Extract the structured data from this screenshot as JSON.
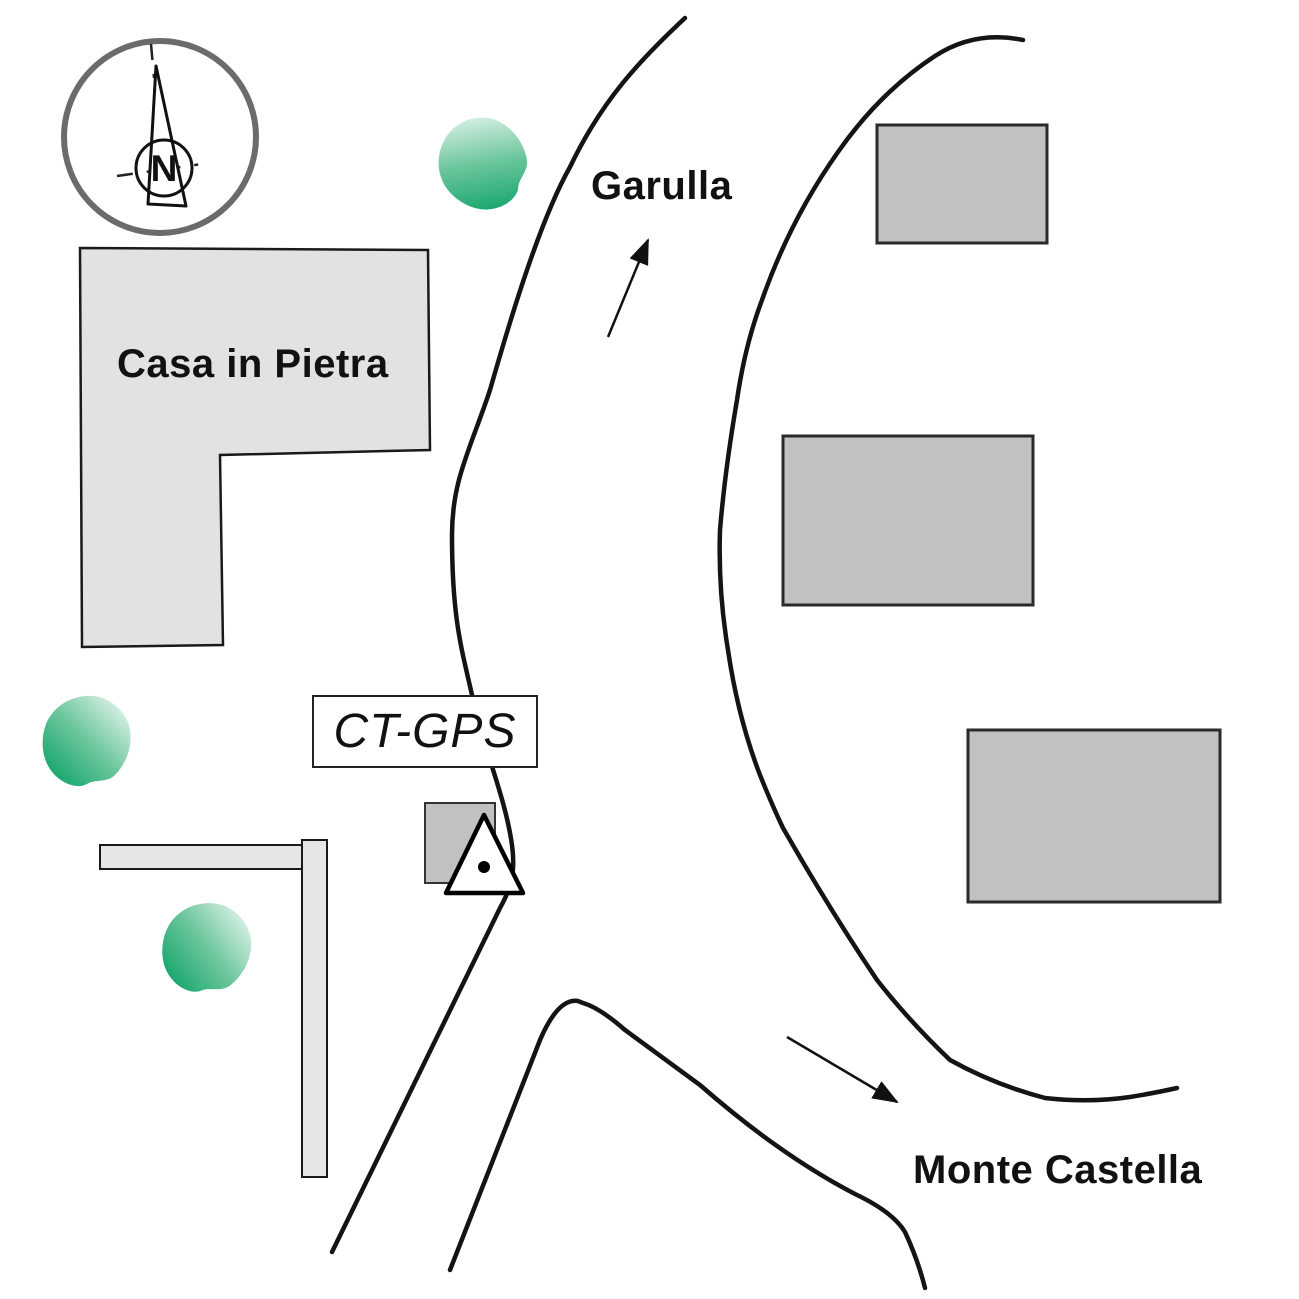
{
  "labels": {
    "house": "Casa in Pietra",
    "road_destination_north": "Garulla",
    "road_destination_south": "Monte Castella",
    "station": "CT-GPS",
    "compass_north": "N"
  },
  "colors": {
    "building_fill": "#c1c1c1",
    "building_stroke": "#2a2a2a",
    "house_fill": "#e2e2e2",
    "wall_fill": "#e6e6e6",
    "road_stroke": "#141414",
    "tree_green_dark": "#009e60",
    "tree_green_light": "#f4fbf7",
    "compass_ring_gray": "#6b6b6b",
    "station_marker_fill": "#ffffff",
    "station_marker_dot": "#000000"
  },
  "features": {
    "buildings_count": 3,
    "trees_count": 3,
    "station_marker": "triangle with center dot",
    "arrows": [
      {
        "to": "Garulla",
        "direction": "up-right"
      },
      {
        "to": "Monte Castella",
        "direction": "down-right"
      }
    ]
  }
}
